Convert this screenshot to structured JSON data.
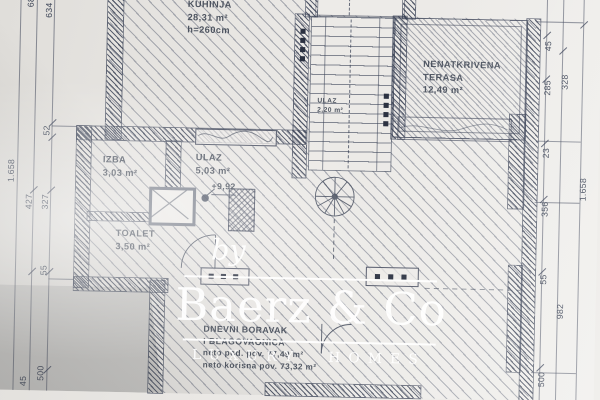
{
  "plan": {
    "rooms": {
      "kuhinja": {
        "name": "KUHINJA",
        "area": "28,31 m²",
        "height": "h=260cm"
      },
      "terasa": {
        "name_line1": "NENATKRIVENA",
        "name_line2": "TERASA",
        "area": "12,49 m²"
      },
      "ulaz_stubiste": {
        "name": "ULAZ",
        "area": "2,20 m²"
      },
      "izba": {
        "name": "IZBA",
        "area": "3,03 m²"
      },
      "ulaz": {
        "name": "ULAZ",
        "area": "5,03 m²"
      },
      "toalet": {
        "name": "TOALET",
        "area": "3,50 m²"
      },
      "dnevni": {
        "name_line1": "DNEVNI BORAVAK",
        "name_line2": "I BLAGOVAONICA",
        "area_line1": "neto pod. pov. 77,49 m²",
        "area_line2": "neto korisna pov. 73,32 m²"
      }
    },
    "elevation_marker": "+9,92",
    "dimensions": {
      "left": [
        "686",
        "634",
        "52",
        "1.658",
        "427",
        "327",
        "55",
        "45",
        "500"
      ],
      "right": [
        "45",
        "285",
        "328",
        "23",
        "356",
        "1.658",
        "55",
        "982",
        "500"
      ]
    }
  },
  "watermark": {
    "prefix": "by",
    "brand": "Baerz & Co",
    "tagline": "LUXURY HOMES"
  },
  "colors": {
    "ink": "#3c4456",
    "paper": "#eceae7",
    "watermark": "#ffffff"
  }
}
